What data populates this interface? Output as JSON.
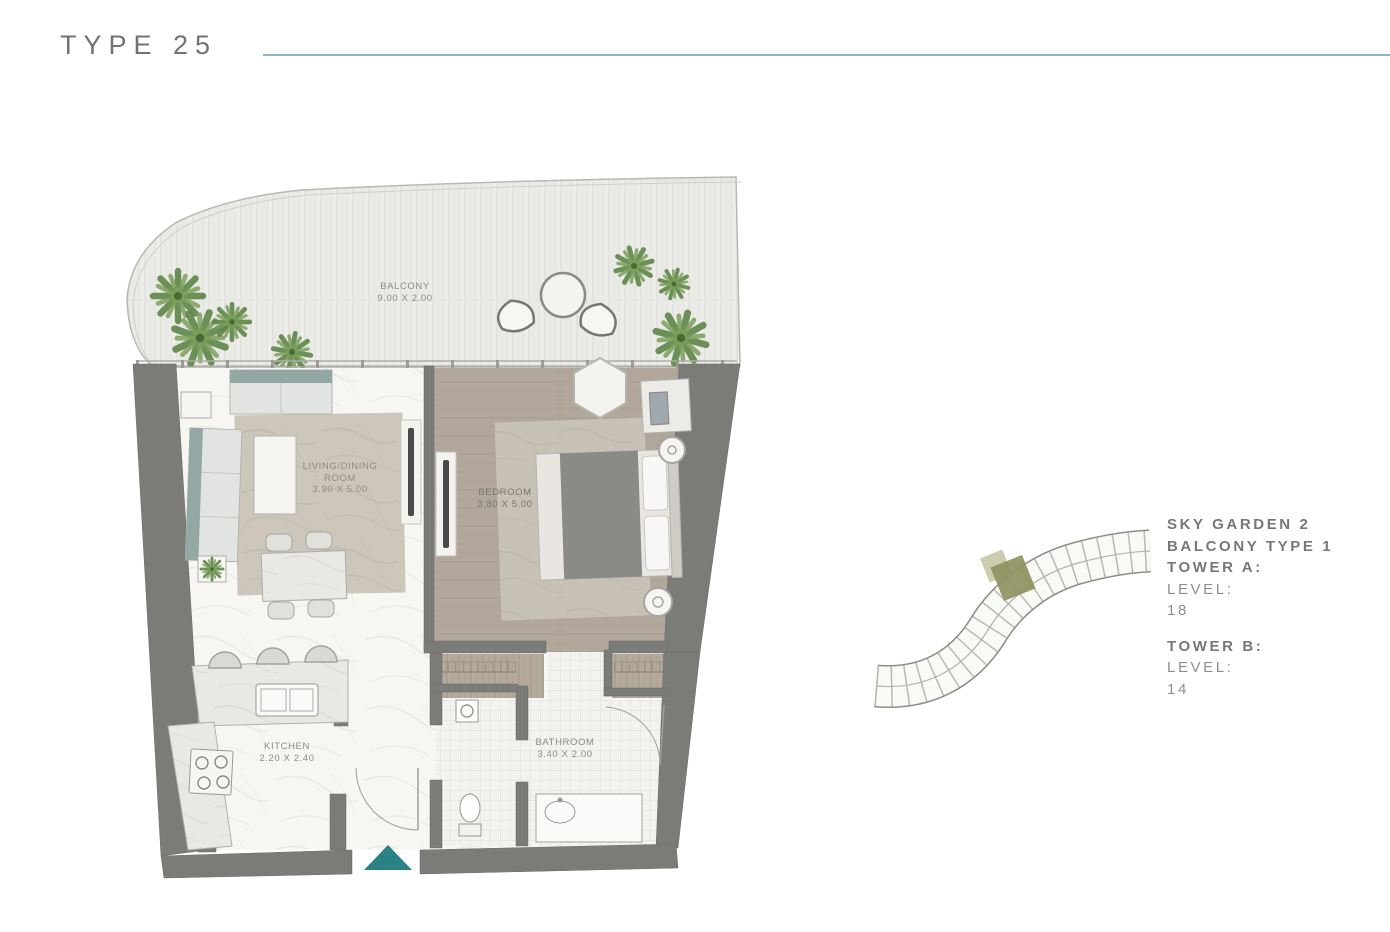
{
  "header": {
    "title": "TYPE 25"
  },
  "floor_plan": {
    "rooms": [
      {
        "id": "balcony",
        "lines": [
          "BALCONY",
          "9.00 X 2.00"
        ]
      },
      {
        "id": "living-dining",
        "lines": [
          "LIVING/DINING",
          "ROOM",
          "3.90 X 5.00"
        ]
      },
      {
        "id": "bedroom",
        "lines": [
          "BEDROOM",
          "3.80 X 5.00"
        ]
      },
      {
        "id": "kitchen",
        "lines": [
          "KITCHEN",
          "2.20 X 2.40"
        ]
      },
      {
        "id": "bathroom",
        "lines": [
          "BATHROOM",
          "3.40 X 2.00"
        ]
      }
    ],
    "entrance_marker": {
      "icon": "entrance-arrow-icon",
      "color": "#2a8284"
    },
    "wall_color": "#7b7b78"
  },
  "key_plan": {
    "highlight_color": "#8f905f",
    "secondary_highlight_color": "#b6b68c"
  },
  "info_panel": {
    "lines": [
      {
        "text": "SKY GARDEN 2",
        "weight": "bold"
      },
      {
        "text": "BALCONY TYPE 1",
        "weight": "bold"
      },
      {
        "text": "TOWER A:",
        "weight": "bold"
      },
      {
        "text": "LEVEL:",
        "weight": "regular"
      },
      {
        "text": "18",
        "weight": "regular"
      },
      {
        "text": "TOWER B:",
        "weight": "bold"
      },
      {
        "text": "LEVEL:",
        "weight": "regular"
      },
      {
        "text": "14",
        "weight": "regular"
      }
    ]
  },
  "colors": {
    "accent_line": "#8cb6c9",
    "title_text": "#6f7377",
    "plant_green": "#5e8748"
  }
}
